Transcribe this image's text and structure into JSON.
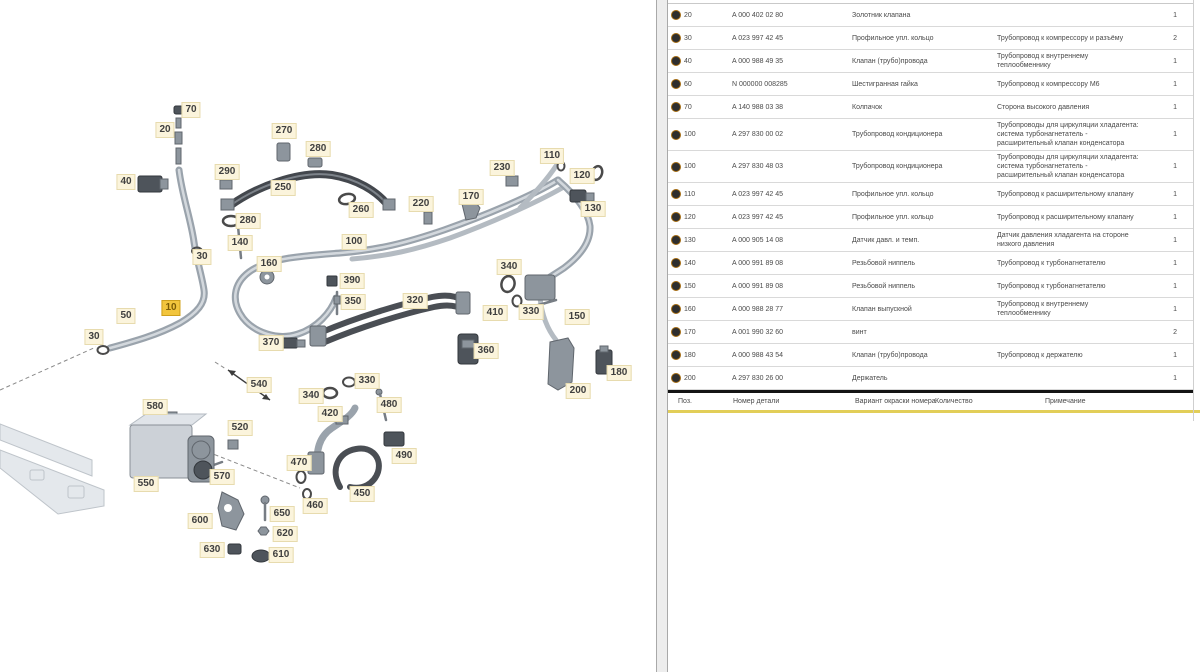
{
  "diagram": {
    "highlight_color": "#f2c53d",
    "callouts": [
      {
        "text": "70",
        "x": 191,
        "y": 110
      },
      {
        "text": "20",
        "x": 165,
        "y": 130
      },
      {
        "text": "40",
        "x": 126,
        "y": 182
      },
      {
        "text": "290",
        "x": 227,
        "y": 172
      },
      {
        "text": "270",
        "x": 284,
        "y": 131
      },
      {
        "text": "280",
        "x": 318,
        "y": 149
      },
      {
        "text": "250",
        "x": 283,
        "y": 188
      },
      {
        "text": "260",
        "x": 361,
        "y": 210
      },
      {
        "text": "280",
        "x": 248,
        "y": 221
      },
      {
        "text": "220",
        "x": 421,
        "y": 204
      },
      {
        "text": "170",
        "x": 471,
        "y": 197
      },
      {
        "text": "230",
        "x": 502,
        "y": 168
      },
      {
        "text": "110",
        "x": 552,
        "y": 156
      },
      {
        "text": "120",
        "x": 582,
        "y": 176
      },
      {
        "text": "130",
        "x": 593,
        "y": 209
      },
      {
        "text": "140",
        "x": 240,
        "y": 243
      },
      {
        "text": "30",
        "x": 202,
        "y": 257
      },
      {
        "text": "160",
        "x": 269,
        "y": 264
      },
      {
        "text": "100",
        "x": 354,
        "y": 242
      },
      {
        "text": "390",
        "x": 352,
        "y": 281
      },
      {
        "text": "350",
        "x": 353,
        "y": 302
      },
      {
        "text": "320",
        "x": 415,
        "y": 301
      },
      {
        "text": "340",
        "x": 509,
        "y": 267
      },
      {
        "text": "410",
        "x": 495,
        "y": 313
      },
      {
        "text": "330",
        "x": 531,
        "y": 312
      },
      {
        "text": "150",
        "x": 577,
        "y": 317
      },
      {
        "text": "360",
        "x": 486,
        "y": 351
      },
      {
        "text": "10",
        "x": 171,
        "y": 308,
        "highlight": true
      },
      {
        "text": "50",
        "x": 126,
        "y": 316
      },
      {
        "text": "30",
        "x": 94,
        "y": 337
      },
      {
        "text": "370",
        "x": 271,
        "y": 343
      },
      {
        "text": "540",
        "x": 259,
        "y": 385
      },
      {
        "text": "330",
        "x": 367,
        "y": 381
      },
      {
        "text": "340",
        "x": 311,
        "y": 396
      },
      {
        "text": "480",
        "x": 389,
        "y": 405
      },
      {
        "text": "420",
        "x": 330,
        "y": 414
      },
      {
        "text": "490",
        "x": 404,
        "y": 456
      },
      {
        "text": "470",
        "x": 299,
        "y": 463
      },
      {
        "text": "450",
        "x": 362,
        "y": 494
      },
      {
        "text": "460",
        "x": 315,
        "y": 506
      },
      {
        "text": "580",
        "x": 155,
        "y": 407
      },
      {
        "text": "520",
        "x": 240,
        "y": 428
      },
      {
        "text": "550",
        "x": 146,
        "y": 484
      },
      {
        "text": "570",
        "x": 222,
        "y": 477
      },
      {
        "text": "600",
        "x": 200,
        "y": 521
      },
      {
        "text": "650",
        "x": 282,
        "y": 514
      },
      {
        "text": "620",
        "x": 285,
        "y": 534
      },
      {
        "text": "630",
        "x": 212,
        "y": 550
      },
      {
        "text": "610",
        "x": 281,
        "y": 555
      },
      {
        "text": "200",
        "x": 578,
        "y": 391
      },
      {
        "text": "180",
        "x": 619,
        "y": 373
      }
    ]
  },
  "table": {
    "header": {
      "pos": "Поз.",
      "part": "Номер детали",
      "name": "Вариант окраски номера",
      "qty": "Количество",
      "note": "Примечание"
    },
    "rows": [
      {
        "pos": "20",
        "part": "A 000 402 02 80",
        "name": "Золотник клапана",
        "note": "",
        "qty": "1"
      },
      {
        "pos": "30",
        "part": "A 023 997 42 45",
        "name": "Профильное упл. кольцо",
        "note": "Трубопровод к компрессору и разъёму",
        "qty": "2"
      },
      {
        "pos": "40",
        "part": "A 000 988 49 35",
        "name": "Клапан (трубо)провода",
        "note": "Трубопровод к внутреннему теплообменнику",
        "qty": "1"
      },
      {
        "pos": "60",
        "part": "N 000000 008285",
        "name": "Шестигранная гайка",
        "note": "Трубопровод к компрессору M6",
        "qty": "1"
      },
      {
        "pos": "70",
        "part": "A 140 988 03 38",
        "name": "Колпачок",
        "note": "Сторона высокого давления",
        "qty": "1"
      },
      {
        "pos": "100",
        "part": "A 297 830 00 02",
        "name": "Трубопровод кондиционера",
        "note": "Трубопроводы для циркуляции хладагента: система турбонагнетатель - расширительный клапан конденсатора",
        "qty": "1"
      },
      {
        "pos": "100",
        "part": "A 297 830 48 03",
        "name": "Трубопровод кондиционера",
        "note": "Трубопроводы для циркуляции хладагента: система турбонагнетатель - расширительный клапан конденсатора",
        "qty": "1"
      },
      {
        "pos": "110",
        "part": "A 023 997 42 45",
        "name": "Профильное упл. кольцо",
        "note": "Трубопровод к расширительному клапану",
        "qty": "1"
      },
      {
        "pos": "120",
        "part": "A 023 997 42 45",
        "name": "Профильное упл. кольцо",
        "note": "Трубопровод к расширительному клапану",
        "qty": "1"
      },
      {
        "pos": "130",
        "part": "A 000 905 14 08",
        "name": "Датчик давл. и темп.",
        "note": "Датчик давления хладагента на стороне низкого давления",
        "qty": "1"
      },
      {
        "pos": "140",
        "part": "A 000 991 89 08",
        "name": "Резьбовой ниппель",
        "note": "Трубопровод к турбонагнетателю",
        "qty": "1"
      },
      {
        "pos": "150",
        "part": "A 000 991 89 08",
        "name": "Резьбовой ниппель",
        "note": "Трубопровод к турбонагнетателю",
        "qty": "1"
      },
      {
        "pos": "160",
        "part": "A 000 988 28 77",
        "name": "Клапан выпускной",
        "note": "Трубопровод к внутреннему теплообменнику",
        "qty": "1"
      },
      {
        "pos": "170",
        "part": "A 001 990 32 60",
        "name": "винт",
        "note": "",
        "qty": "2"
      },
      {
        "pos": "180",
        "part": "A 000 988 43 54",
        "name": "Клапан (трубо)провода",
        "note": "Трубопровод к держателю",
        "qty": "1"
      },
      {
        "pos": "200",
        "part": "A 297 830 26 00",
        "name": "Держатель",
        "note": "",
        "qty": "1"
      }
    ]
  }
}
